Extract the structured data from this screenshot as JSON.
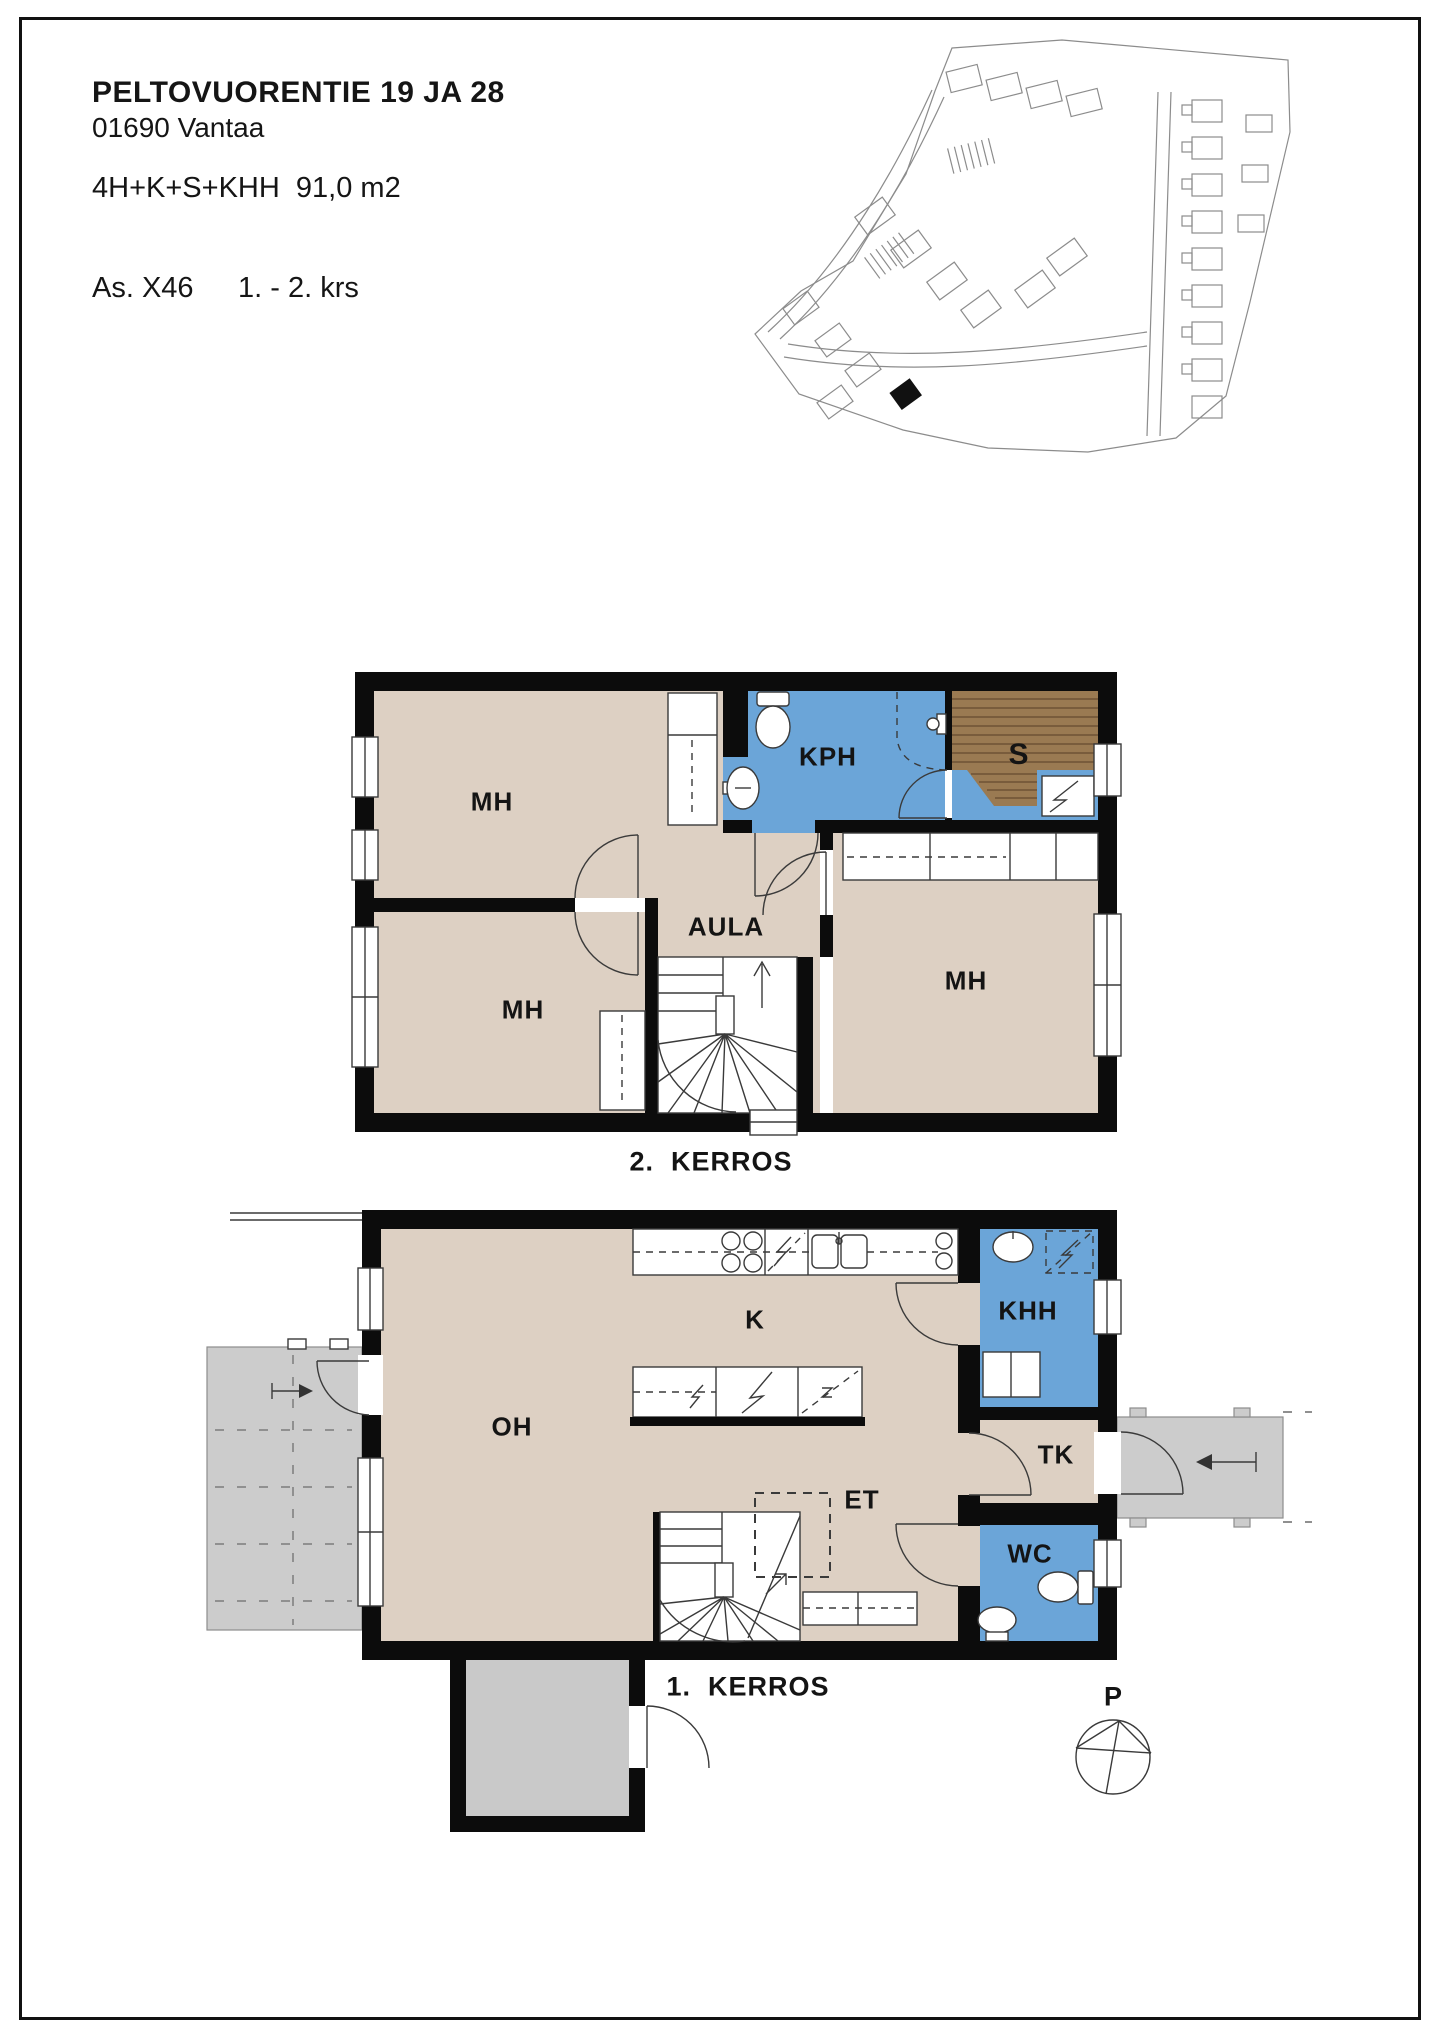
{
  "header": {
    "title": "PELTOVUORENTIE 19 JA 28",
    "address": "01690 Vantaa",
    "apartment_type": "4H+K+S+KHH  91,0 m2",
    "unit_id": "As. X46",
    "floor_range": "1. - 2. krs"
  },
  "floor_2": {
    "label": "2.  KERROS",
    "rooms": {
      "mh_top": "MH",
      "mh_bottom": "MH",
      "mh_right": "MH",
      "kph": "KPH",
      "sauna": "S",
      "aula": "AULA"
    }
  },
  "floor_1": {
    "label": "1.  KERROS",
    "rooms": {
      "oh": "OH",
      "kitchen": "K",
      "et": "ET",
      "khh": "KHH",
      "tk": "TK",
      "wc": "WC"
    }
  },
  "compass": {
    "north_label": "P"
  },
  "colors": {
    "room_fill": "#ddd0c3",
    "wet_room_fill": "#6ba5d8",
    "sauna_wood": "#9a7a52",
    "sauna_wood_line": "#6e5335",
    "outdoor_gray": "#cccccc",
    "storage_gray": "#c9c9c9",
    "wall": "#0c0c0c",
    "line": "#3a3a3a",
    "site_line": "#8c8c8c"
  }
}
